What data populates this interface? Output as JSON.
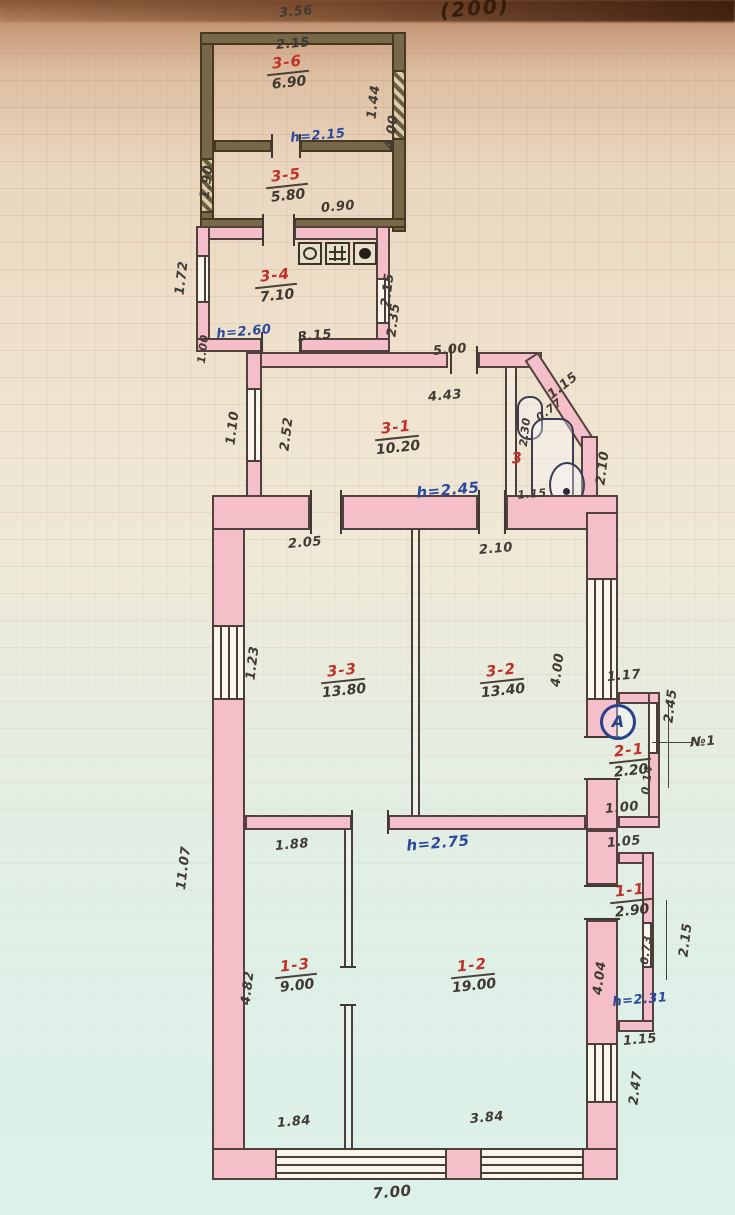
{
  "header": {
    "fragment": "(200)"
  },
  "rooms": {
    "r36": {
      "id": "3-6",
      "area": "6.90"
    },
    "r35": {
      "id": "3-5",
      "area": "5.80"
    },
    "r34": {
      "id": "3-4",
      "area": "7.10"
    },
    "r31": {
      "id": "3-1",
      "area": "10.20"
    },
    "r33": {
      "id": "3-3",
      "area": "13.80"
    },
    "r32": {
      "id": "3-2",
      "area": "13.40"
    },
    "r21": {
      "id": "2-1",
      "area": "2.20"
    },
    "r11": {
      "id": "1-1",
      "area": "2.90"
    },
    "r13": {
      "id": "1-3",
      "area": "9.00"
    },
    "r12": {
      "id": "1-2",
      "area": "19.00"
    }
  },
  "notes": {
    "h36": "h=2.15",
    "h34": "h=2.60",
    "h31": "h=2.45",
    "h12": "h=2.75",
    "h11": "h=2.31",
    "point_a": "A",
    "bath_num": "3",
    "mark_n1": "№1"
  },
  "dims": {
    "annex_top_width": "3.56",
    "r36_inner_width": "2.15",
    "r36_right_window": "1.44",
    "annex_right_side": "4.00",
    "r35_left": "1.90",
    "r35_right_offset": "0.90",
    "r34_left": "1.72",
    "r34_right_upper": "2.15",
    "r34_right_lower": "2.35",
    "r34_bottom": "3.15",
    "step_left": "1.00",
    "main_top": "5.00",
    "chamfer": "1.15",
    "r31_width": "4.43",
    "r31_left_window": "1.10",
    "r31_left_inner": "2.52",
    "bath_left": "2.30",
    "bath_chamfer_inner": "0.77",
    "bath_bottom": "1.15",
    "bath_right": "2.10",
    "r33_top": "2.05",
    "r32_top": "2.10",
    "r33_left_window": "1.23",
    "r32_right_inner": "4.00",
    "annex2_top": "1.17",
    "annex2_right": "2.45",
    "annex2_wall": "0.14",
    "annex2_bottom": "1.00",
    "annex1_top": "1.05",
    "r13_top": "1.88",
    "r13_left": "4.82",
    "main_left": "11.07",
    "r12_right": "4.04",
    "annex1_wall": "0.73",
    "annex1_right": "2.15",
    "annex1_bottom": "1.15",
    "bottom_window_left": "1.84",
    "bottom_window_right": "3.84",
    "bottom_width": "7.00",
    "right_lower": "2.47"
  }
}
